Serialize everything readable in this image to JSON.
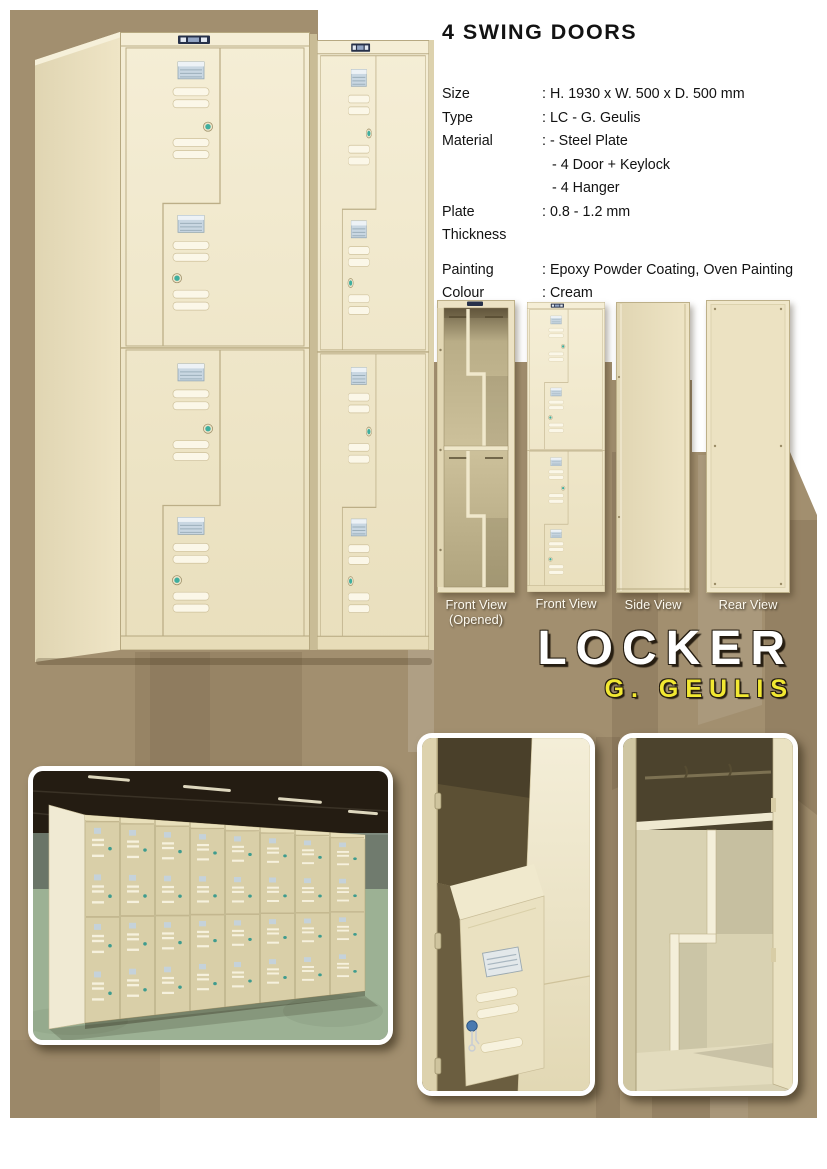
{
  "header": {
    "title": "4 SWING DOORS"
  },
  "specs": {
    "rows": [
      {
        "label": "Size",
        "value": ": H. 1930 x W. 500 x D. 500 mm"
      },
      {
        "label": "Type",
        "value": ": LC - G. Geulis"
      },
      {
        "label": "Material",
        "value": ": - Steel Plate"
      },
      {
        "label": "",
        "value": "- 4 Door + Keylock"
      },
      {
        "label": "",
        "value": "- 4 Hanger"
      },
      {
        "label": "Plate Thickness",
        "value": ": 0.8 - 1.2 mm"
      },
      {
        "label": "Painting",
        "value": ": Epoxy Powder Coating, Oven Painting"
      },
      {
        "label": "Colour",
        "value": ": Cream"
      }
    ]
  },
  "views": {
    "items": [
      {
        "line1": "Front View",
        "line2": "(Opened)"
      },
      {
        "line1": "Front View"
      },
      {
        "line1": "Side View"
      },
      {
        "line1": "Rear View"
      }
    ]
  },
  "brand": {
    "product": "LOCKER",
    "model": "G. GEULIS"
  },
  "colors": {
    "background_taupe": "#a28f6f",
    "background_taupe_dark": "#8a795d",
    "locker_cream": "#f3ecd2",
    "locker_cream_shade": "#e6dbba",
    "interior_khaki": "#c7bb95",
    "lock_teal": "#3fae9e",
    "card_holder_blue": "#c9d7e2",
    "brand_white": "#ffffff",
    "brand_yellow": "#f2e832",
    "text_black": "#121212",
    "photo_floor_green": "#9cb194",
    "photo_wall_gray": "#7e8a7e",
    "photo_ceiling_dark": "#241c12",
    "photo_locker_tan": "#d9cfa8"
  }
}
